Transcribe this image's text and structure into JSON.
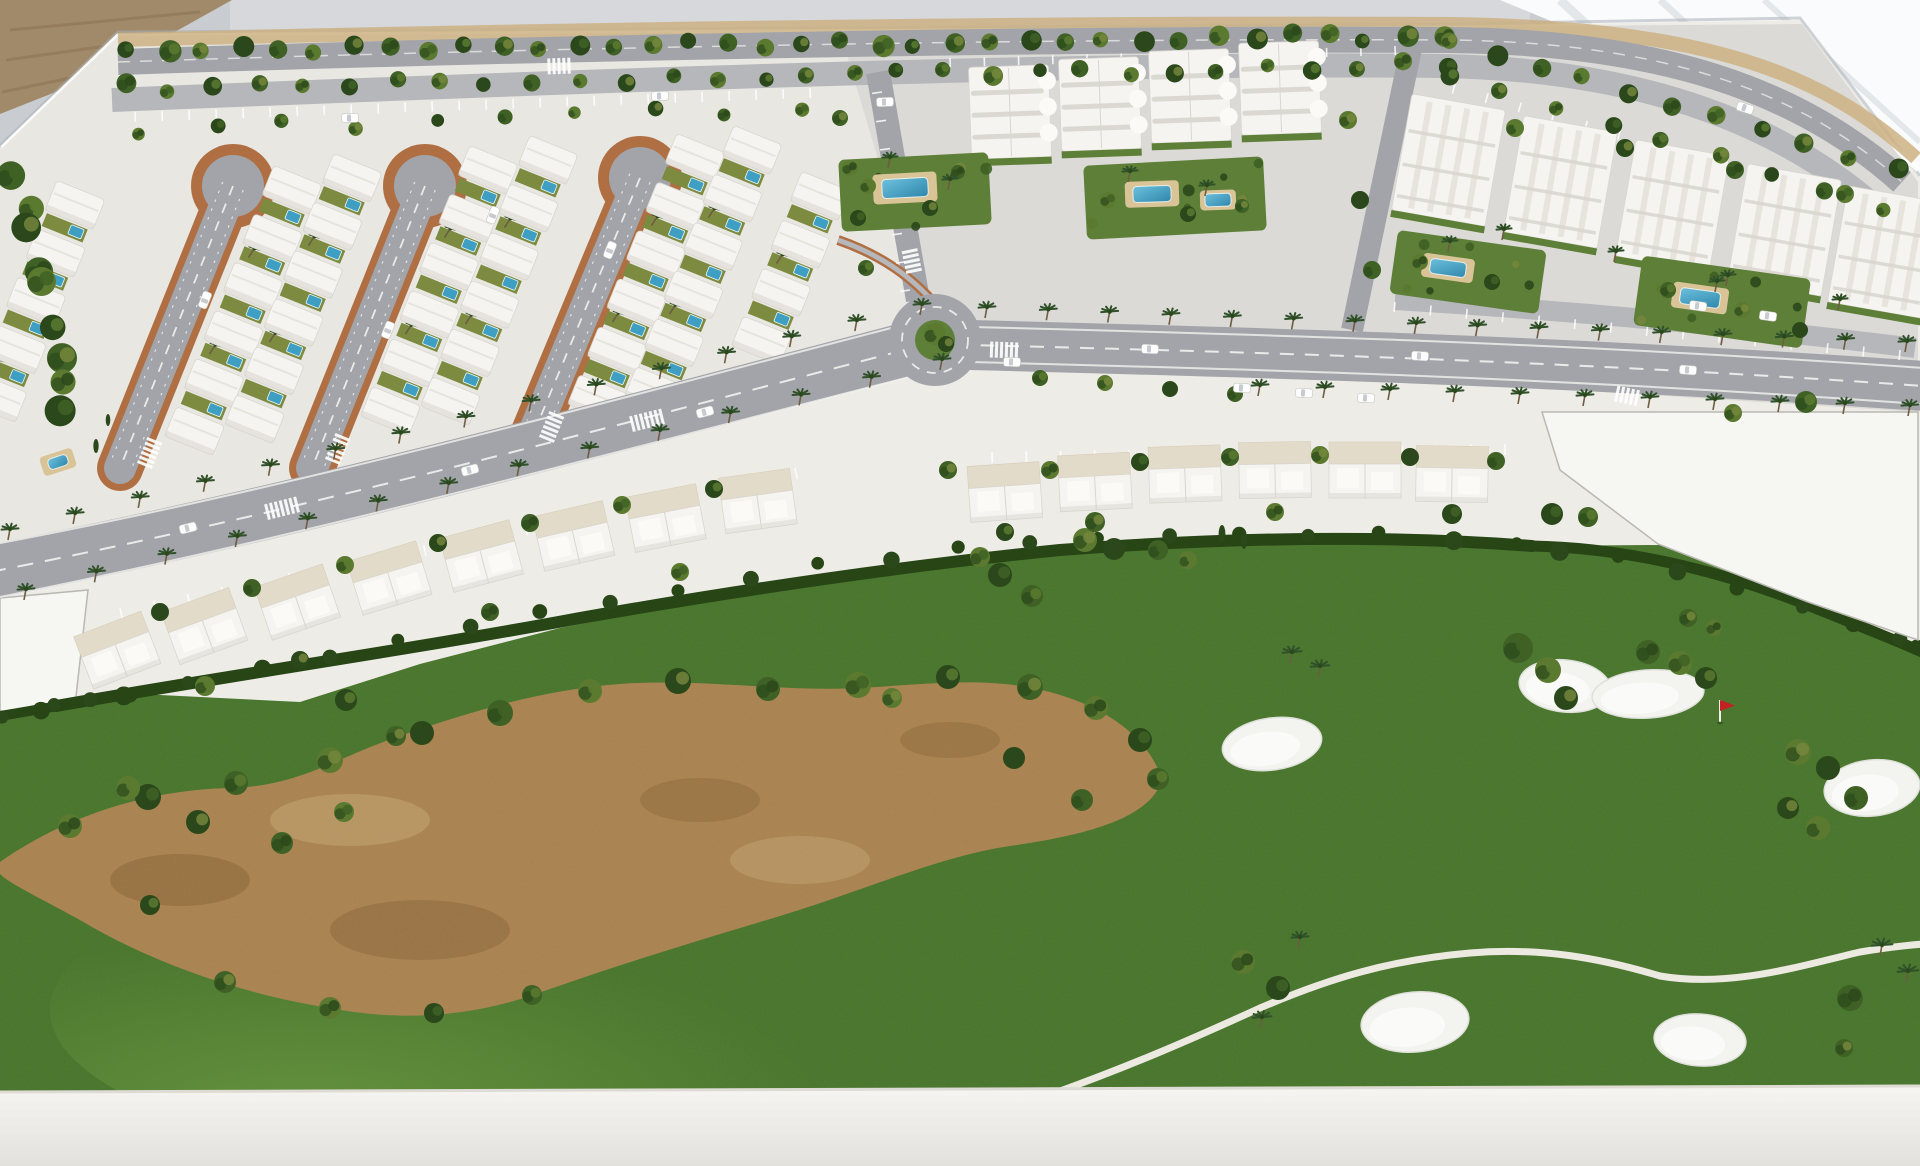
{
  "alt": "Photograph of a white architectural scale model of a golf resort community: rows of white villas around three cul-de-sac loop roads, white apartment blocks with pools and palm-lined avenues in the upper right, townhouse rows along a curving main avenue with a roundabout, and a large model golf course with green turf, a sandy waste area, white bunkers, a red flag pin and a winding cart path in the foreground",
  "palette": {
    "wall": "#c9ccd1",
    "wallLight": "#dde0e3",
    "bright": "#fafbfc",
    "streak": "#e4e7ea",
    "edgeShadow": "#aab0b6",
    "card": "#a18a6a",
    "cardDark": "#8c7355",
    "board": "#eeece7",
    "zoneVilla": "#e9e7e1",
    "zoneApt": "#dbdad6",
    "bldg": "#f5f4f0",
    "bldgShade": "#d9d6cf",
    "bldgLine": "#e6e4dd",
    "road": "#a2a4a9",
    "roadLight": "#b6b7bb",
    "lane": "#f2f2ef",
    "terra": "#b06f42",
    "yard": "#7c8b40",
    "gardenGreen": "#5d7f37",
    "golf": "#49752c",
    "golfDark": "#335c1e",
    "golfLight": "#63913c",
    "hedge": "#274515",
    "sand": "#a9824f",
    "sandDark": "#7e5c33",
    "sandLight": "#cdb183",
    "bunker": "#f3f4ef",
    "bunkerEdge": "#dfe0da",
    "pool": "#3f9fc2",
    "poolLight": "#6cc0dc",
    "deck": "#d9c498",
    "treeDark": "#2b481b",
    "tree2": "#3f6125",
    "tree3": "#5b7a30",
    "tree4": "#74863c",
    "palm": "#30512a",
    "trunk": "#6f5c42",
    "white": "#ffffff",
    "base": "#f2f1ed",
    "baseShade": "#ddDBd4",
    "parcel": "#f6f6f3",
    "parcelLine": "#b9b9b2",
    "car": "#fdfdfd",
    "carGlass": "#b9bdc2",
    "flag": "#c42222",
    "cartPath": "#ece9e0"
  },
  "treeRows": [
    {
      "f": [
        128,
        52
      ],
      "t": [
        1442,
        36
      ],
      "n": 36,
      "r": 9,
      "ty": 1,
      "j": 5
    },
    {
      "f": [
        122,
        88
      ],
      "t": [
        1448,
        64
      ],
      "n": 30,
      "r": 8,
      "ty": 1,
      "j": 5
    },
    {
      "f": [
        1452,
        42
      ],
      "t": [
        1895,
        168
      ],
      "n": 11,
      "r": 9,
      "ty": 1,
      "j": 4
    },
    {
      "f": [
        1448,
        78
      ],
      "t": [
        1880,
        206
      ],
      "n": 9,
      "r": 8,
      "ty": 1,
      "j": 4
    },
    {
      "f": [
        14,
        165
      ],
      "t": [
        66,
        420
      ],
      "n": 9,
      "r": 14,
      "ty": 1,
      "j": 12
    },
    {
      "f": [
        140,
        130
      ],
      "t": [
        800,
        108
      ],
      "n": 10,
      "r": 7,
      "ty": 1,
      "j": 6
    }
  ],
  "palmRows": [
    {
      "f": [
        8,
        540
      ],
      "t": [
        920,
        315
      ],
      "n": 15
    },
    {
      "f": [
        24,
        600
      ],
      "t": [
        940,
        370
      ],
      "n": 14
    },
    {
      "f": [
        985,
        318
      ],
      "t": [
        1905,
        352
      ],
      "n": 16
    },
    {
      "f": [
        1258,
        396
      ],
      "t": [
        1908,
        416
      ],
      "n": 11
    }
  ],
  "parkingRows": [
    {
      "f": [
        135,
        112
      ],
      "t": [
        810,
        88
      ],
      "n": 26,
      "l": 10
    },
    {
      "f": [
        1455,
        84
      ],
      "t": [
        1885,
        204
      ],
      "n": 14,
      "l": 10
    },
    {
      "f": [
        120,
        608
      ],
      "t": [
        795,
        468
      ],
      "n": 21,
      "l": 11
    },
    {
      "f": [
        992,
        452
      ],
      "t": [
        1505,
        444
      ],
      "n": 16,
      "l": 11
    },
    {
      "f": [
        1395,
        302
      ],
      "t": [
        1900,
        350
      ],
      "n": 15,
      "l": 10
    },
    {
      "f": [
        882,
        92
      ],
      "t": [
        910,
        290
      ],
      "n": 8,
      "l": 10
    },
    {
      "f": [
        950,
        58
      ],
      "t": [
        1395,
        46
      ],
      "n": 14,
      "l": 9
    }
  ],
  "loops": [
    {
      "b": [
        233,
        186
      ],
      "e": [
        120,
        468
      ]
    },
    {
      "b": [
        425,
        186
      ],
      "e": [
        312,
        468
      ]
    },
    {
      "b": [
        640,
        178
      ],
      "e": [
        530,
        442
      ]
    }
  ],
  "villaColumns": [
    {
      "x": 75,
      "y": 205,
      "n": 5
    },
    {
      "x": 292,
      "y": 190,
      "n": 6
    },
    {
      "x": 352,
      "y": 178,
      "n": 6
    },
    {
      "x": 488,
      "y": 170,
      "n": 6
    },
    {
      "x": 548,
      "y": 160,
      "n": 6
    },
    {
      "x": 695,
      "y": 158,
      "n": 6
    },
    {
      "x": 752,
      "y": 150,
      "n": 6
    },
    {
      "x": 820,
      "y": 196,
      "n": 4
    }
  ],
  "townhouses": [
    [
      118,
      652,
      -21
    ],
    [
      205,
      628,
      -20
    ],
    [
      298,
      604,
      -19
    ],
    [
      390,
      580,
      -17
    ],
    [
      482,
      558,
      -15
    ],
    [
      574,
      538,
      -13
    ],
    [
      666,
      520,
      -11
    ],
    [
      758,
      503,
      -8
    ],
    [
      1005,
      494,
      -4
    ],
    [
      1095,
      484,
      -3
    ],
    [
      1185,
      476,
      -2
    ],
    [
      1275,
      472,
      -1
    ],
    [
      1365,
      472,
      0
    ],
    [
      1452,
      476,
      1
    ]
  ],
  "aptRowA": [
    [
      1010,
      112
    ],
    [
      1100,
      104
    ],
    [
      1190,
      96
    ],
    [
      1280,
      88
    ]
  ],
  "aptRowB": [
    [
      1448,
      160
    ],
    [
      1560,
      182
    ],
    [
      1672,
      206
    ],
    [
      1784,
      230
    ],
    [
      1884,
      252
    ]
  ],
  "gardens": [
    {
      "x": 915,
      "y": 192,
      "w": 150,
      "h": 72,
      "a": -3
    },
    {
      "x": 1175,
      "y": 198,
      "w": 180,
      "h": 74,
      "a": -3
    },
    {
      "x": 1468,
      "y": 272,
      "w": 150,
      "h": 64,
      "a": 8
    },
    {
      "x": 1722,
      "y": 302,
      "w": 170,
      "h": 70,
      "a": 8
    }
  ],
  "pools": [
    {
      "x": 905,
      "y": 188,
      "w": 46,
      "h": 19,
      "a": -3,
      "d": [
        64,
        30
      ]
    },
    {
      "x": 1152,
      "y": 194,
      "w": 38,
      "h": 16,
      "a": -2,
      "d": [
        54,
        26
      ]
    },
    {
      "x": 1218,
      "y": 200,
      "w": 26,
      "h": 13,
      "a": -2,
      "d": [
        36,
        20
      ]
    },
    {
      "x": 1448,
      "y": 268,
      "w": 36,
      "h": 15,
      "a": 8,
      "d": [
        52,
        24
      ]
    },
    {
      "x": 1700,
      "y": 298,
      "w": 40,
      "h": 16,
      "a": 8,
      "d": [
        56,
        26
      ]
    },
    {
      "x": 58,
      "y": 462,
      "w": 20,
      "h": 11,
      "a": -18,
      "d": [
        34,
        20
      ]
    }
  ],
  "bunkers": [
    [
      1272,
      744,
      50,
      26,
      -8
    ],
    [
      1565,
      686,
      46,
      26,
      6
    ],
    [
      1648,
      694,
      56,
      24,
      -4
    ],
    [
      1872,
      788,
      48,
      28,
      -6
    ],
    [
      1415,
      1022,
      54,
      30,
      -5
    ],
    [
      1700,
      1040,
      46,
      26,
      4
    ]
  ],
  "flag": {
    "x": 1720,
    "y": 722
  },
  "cars": [
    [
      350,
      118,
      -2
    ],
    [
      660,
      96,
      -2
    ],
    [
      885,
      102,
      -2
    ],
    [
      188,
      528,
      -14
    ],
    [
      470,
      470,
      -15
    ],
    [
      705,
      412,
      -15
    ],
    [
      1150,
      349,
      2
    ],
    [
      1420,
      356,
      3
    ],
    [
      1688,
      370,
      4
    ],
    [
      205,
      300,
      -68
    ],
    [
      388,
      330,
      -68
    ],
    [
      493,
      215,
      -68
    ],
    [
      610,
      250,
      -68
    ],
    [
      1698,
      306,
      8
    ],
    [
      1768,
      316,
      8
    ],
    [
      1242,
      388,
      3
    ],
    [
      1304,
      393,
      3
    ],
    [
      1366,
      398,
      3
    ],
    [
      1745,
      108,
      18
    ],
    [
      1012,
      362,
      2
    ]
  ],
  "crosswalks": [
    [
      283,
      508,
      -14,
      7
    ],
    [
      648,
      420,
      -14,
      7
    ],
    [
      1005,
      350,
      2,
      6
    ],
    [
      912,
      262,
      78,
      5
    ],
    [
      150,
      452,
      -68,
      6
    ],
    [
      338,
      448,
      -68,
      6
    ],
    [
      552,
      426,
      -68,
      6
    ],
    [
      1628,
      396,
      12,
      5
    ],
    [
      560,
      66,
      -2,
      5
    ]
  ],
  "hedgeStamps": {
    "main": [
      [
        56,
        706
      ],
      [
        120,
        694
      ],
      [
        190,
        682
      ],
      [
        260,
        670
      ],
      [
        330,
        656
      ],
      [
        400,
        642
      ],
      [
        470,
        628
      ],
      [
        540,
        614
      ],
      [
        610,
        601
      ],
      [
        680,
        589
      ],
      [
        750,
        577
      ],
      [
        820,
        566
      ],
      [
        890,
        557
      ],
      [
        960,
        549
      ],
      [
        1030,
        545
      ],
      [
        1100,
        541
      ],
      [
        1170,
        538
      ],
      [
        1240,
        536
      ],
      [
        1310,
        535
      ],
      [
        1380,
        535
      ],
      [
        1450,
        538
      ],
      [
        1520,
        545
      ]
    ],
    "right": [
      [
        1560,
        550
      ],
      [
        1620,
        556
      ],
      [
        1680,
        570
      ],
      [
        1740,
        589
      ],
      [
        1800,
        606
      ],
      [
        1850,
        622
      ],
      [
        1900,
        640
      ],
      [
        1918,
        650
      ]
    ],
    "left": [
      [
        0,
        716
      ],
      [
        40,
        711
      ],
      [
        90,
        702
      ],
      [
        130,
        696
      ]
    ]
  },
  "trees": [
    [
      1000,
      575,
      12,
      0
    ],
    [
      1032,
      596,
      11,
      0
    ],
    [
      1085,
      540,
      12,
      0
    ],
    [
      1114,
      549,
      11,
      0
    ],
    [
      1158,
      550,
      10,
      1
    ],
    [
      1188,
      560,
      9,
      1
    ],
    [
      1222,
      534,
      9,
      3
    ],
    [
      1244,
      541,
      8,
      3
    ],
    [
      980,
      557,
      10,
      0
    ],
    [
      346,
      700,
      11,
      1
    ],
    [
      396,
      736,
      10,
      1
    ],
    [
      70,
      826,
      12,
      0
    ],
    [
      148,
      797,
      13,
      0
    ],
    [
      236,
      783,
      12,
      0
    ],
    [
      330,
      760,
      13,
      0
    ],
    [
      422,
      733,
      12,
      0
    ],
    [
      500,
      713,
      13,
      0
    ],
    [
      590,
      691,
      12,
      0
    ],
    [
      678,
      681,
      13,
      0
    ],
    [
      768,
      689,
      12,
      0
    ],
    [
      858,
      685,
      13,
      0
    ],
    [
      948,
      677,
      12,
      0
    ],
    [
      1030,
      687,
      13,
      0
    ],
    [
      1096,
      708,
      12,
      0
    ],
    [
      1140,
      740,
      12,
      0
    ],
    [
      1158,
      779,
      11,
      0
    ],
    [
      892,
      698,
      10,
      0
    ],
    [
      1014,
      758,
      11,
      0
    ],
    [
      1082,
      800,
      11,
      0
    ],
    [
      128,
      788,
      12,
      0
    ],
    [
      198,
      822,
      12,
      0
    ],
    [
      282,
      843,
      11,
      0
    ],
    [
      344,
      812,
      10,
      0
    ],
    [
      150,
      905,
      10,
      0
    ],
    [
      225,
      982,
      11,
      0
    ],
    [
      330,
      1008,
      11,
      0
    ],
    [
      434,
      1013,
      10,
      0
    ],
    [
      532,
      995,
      10,
      0
    ],
    [
      1290,
      663,
      10,
      2
    ],
    [
      1318,
      677,
      10,
      2
    ],
    [
      1518,
      648,
      15,
      0
    ],
    [
      1548,
      670,
      13,
      0
    ],
    [
      1566,
      698,
      12,
      0
    ],
    [
      1648,
      652,
      12,
      0
    ],
    [
      1680,
      663,
      12,
      0
    ],
    [
      1706,
      678,
      11,
      0
    ],
    [
      1688,
      618,
      9,
      1
    ],
    [
      1714,
      628,
      8,
      1
    ],
    [
      1552,
      514,
      11,
      1
    ],
    [
      1588,
      517,
      10,
      1
    ],
    [
      1798,
      752,
      13,
      0
    ],
    [
      1828,
      768,
      12,
      0
    ],
    [
      1856,
      798,
      12,
      0
    ],
    [
      1818,
      828,
      12,
      0
    ],
    [
      1788,
      808,
      11,
      0
    ],
    [
      1850,
      998,
      13,
      1
    ],
    [
      1880,
      956,
      11,
      2
    ],
    [
      1906,
      982,
      11,
      2
    ],
    [
      1844,
      1048,
      9,
      0
    ],
    [
      1243,
      962,
      12,
      1
    ],
    [
      1278,
      988,
      12,
      1
    ],
    [
      1260,
      1028,
      10,
      2
    ],
    [
      1298,
      948,
      9,
      2
    ],
    [
      160,
      612,
      9,
      1
    ],
    [
      252,
      588,
      9,
      1
    ],
    [
      345,
      565,
      9,
      1
    ],
    [
      438,
      543,
      9,
      1
    ],
    [
      530,
      523,
      9,
      1
    ],
    [
      622,
      505,
      9,
      1
    ],
    [
      714,
      489,
      9,
      1
    ],
    [
      948,
      470,
      9,
      1
    ],
    [
      1050,
      470,
      9,
      1
    ],
    [
      1140,
      462,
      9,
      1
    ],
    [
      1230,
      457,
      9,
      1
    ],
    [
      1320,
      455,
      9,
      1
    ],
    [
      1410,
      457,
      9,
      1
    ],
    [
      1496,
      461,
      9,
      1
    ],
    [
      205,
      686,
      10,
      1
    ],
    [
      300,
      660,
      9,
      1
    ],
    [
      490,
      612,
      9,
      1
    ],
    [
      680,
      572,
      9,
      1
    ],
    [
      1005,
      532,
      9,
      1
    ],
    [
      1095,
      522,
      10,
      1
    ],
    [
      1275,
      512,
      9,
      1
    ],
    [
      1452,
      514,
      10,
      1
    ],
    [
      1040,
      378,
      8,
      1
    ],
    [
      1105,
      383,
      8,
      1
    ],
    [
      1170,
      389,
      8,
      1
    ],
    [
      1235,
      394,
      8,
      1
    ],
    [
      868,
      186,
      8,
      0
    ],
    [
      930,
      208,
      8,
      0
    ],
    [
      958,
      172,
      7,
      0
    ],
    [
      1108,
      200,
      8,
      0
    ],
    [
      1188,
      214,
      8,
      0
    ],
    [
      1242,
      206,
      7,
      0
    ],
    [
      1420,
      262,
      8,
      0
    ],
    [
      1492,
      282,
      8,
      0
    ],
    [
      1668,
      290,
      8,
      0
    ],
    [
      1742,
      310,
      8,
      0
    ],
    [
      1800,
      330,
      8,
      0
    ],
    [
      888,
      168,
      8,
      2
    ],
    [
      948,
      190,
      8,
      2
    ],
    [
      1128,
      182,
      8,
      2
    ],
    [
      1205,
      196,
      8,
      2
    ],
    [
      1448,
      252,
      8,
      2
    ],
    [
      1715,
      292,
      8,
      2
    ],
    [
      840,
      118,
      8,
      1
    ],
    [
      850,
      168,
      8,
      1
    ],
    [
      858,
      218,
      8,
      1
    ],
    [
      866,
      268,
      8,
      1
    ],
    [
      1348,
      120,
      9,
      1
    ],
    [
      1360,
      200,
      9,
      1
    ],
    [
      1372,
      270,
      9,
      1
    ],
    [
      1515,
      128,
      9,
      1
    ],
    [
      1625,
      148,
      9,
      1
    ],
    [
      1735,
      170,
      9,
      1
    ],
    [
      1845,
      194,
      9,
      1
    ],
    [
      1502,
      240,
      8,
      2
    ],
    [
      1614,
      262,
      8,
      2
    ],
    [
      1726,
      286,
      8,
      2
    ],
    [
      1838,
      310,
      8,
      2
    ],
    [
      1806,
      402,
      11,
      0
    ],
    [
      1733,
      413,
      9,
      1
    ],
    [
      96,
      446,
      7,
      3
    ],
    [
      108,
      420,
      6,
      3
    ],
    [
      935,
      334,
      11,
      1
    ],
    [
      946,
      344,
      8,
      0
    ]
  ]
}
